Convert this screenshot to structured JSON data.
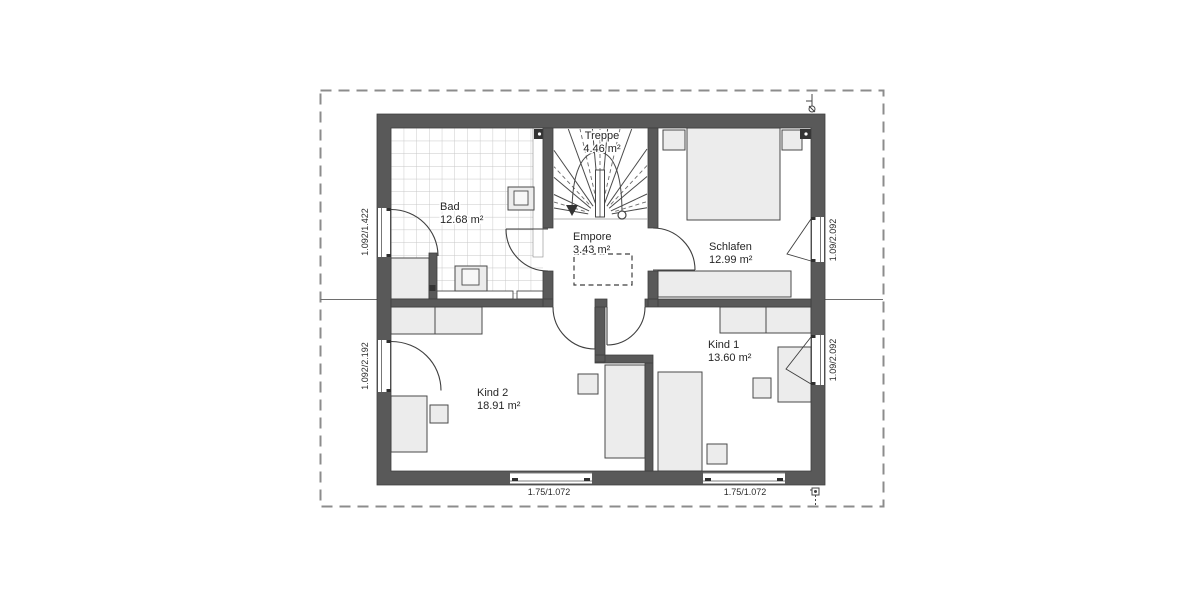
{
  "rooms": [
    {
      "name": "Treppe",
      "area": "4.46 m²"
    },
    {
      "name": "Bad",
      "area": "12.68 m²"
    },
    {
      "name": "Empore",
      "area": "3.43 m²"
    },
    {
      "name": "Schlafen",
      "area": "12.99 m²"
    },
    {
      "name": "Kind 1",
      "area": "13.60 m²"
    },
    {
      "name": "Kind 2",
      "area": "18.91 m²"
    }
  ],
  "windows": [
    {
      "id": "bad-window",
      "label": "1.092/1.422",
      "wall": "left"
    },
    {
      "id": "kind2-window",
      "label": "1.092/2.192",
      "wall": "left"
    },
    {
      "id": "schlafen-window",
      "label": "1.09/2.092",
      "wall": "right"
    },
    {
      "id": "kind1-window",
      "label": "1.09/2.092",
      "wall": "right"
    },
    {
      "id": "kind2-bottom-window",
      "label": "1.75/1.072",
      "wall": "bottom"
    },
    {
      "id": "kind1-bottom-window",
      "label": "1.75/1.072",
      "wall": "bottom"
    }
  ],
  "colors": {
    "wall": "#595959",
    "furniture": "#ececec",
    "tile_line": "#c6c6c6",
    "boundary": "#8c8c8c",
    "background": "#ffffff"
  }
}
